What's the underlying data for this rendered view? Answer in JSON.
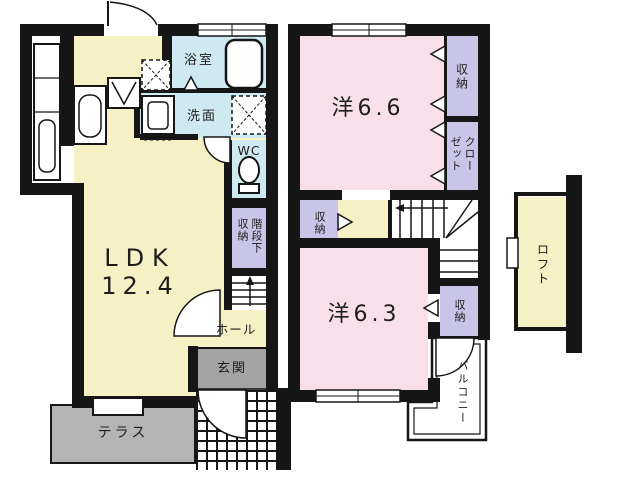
{
  "colors": {
    "wall": "#161616",
    "living_yellow": "#f6f0c5",
    "wet_area_blue": "#cfe9f0",
    "bedroom_pink": "#f9dfe9",
    "storage_lavender": "#c9c5e8",
    "terrace_gray": "#b4b4b4",
    "entrance_gray": "#a3a3a3"
  },
  "floor1": {
    "ldk_label": "LDK",
    "ldk_size": "12.4",
    "bathroom_label": "浴室",
    "washroom_label": "洗面",
    "wc_label": "WC",
    "under_stairs_storage_label": "階段下収納",
    "hall_label": "ホール",
    "entrance_label": "玄関",
    "terrace_label": "テラス"
  },
  "floor2": {
    "bedroom1_label": "洋6.6",
    "bedroom1_storage_label": "収納",
    "closet_label": "クローゼット",
    "hall_storage_label": "収納",
    "bedroom2_label": "洋6.3",
    "bedroom2_storage_label": "収納",
    "balcony_label": "バルコニー",
    "loft_label": "ロフト"
  }
}
